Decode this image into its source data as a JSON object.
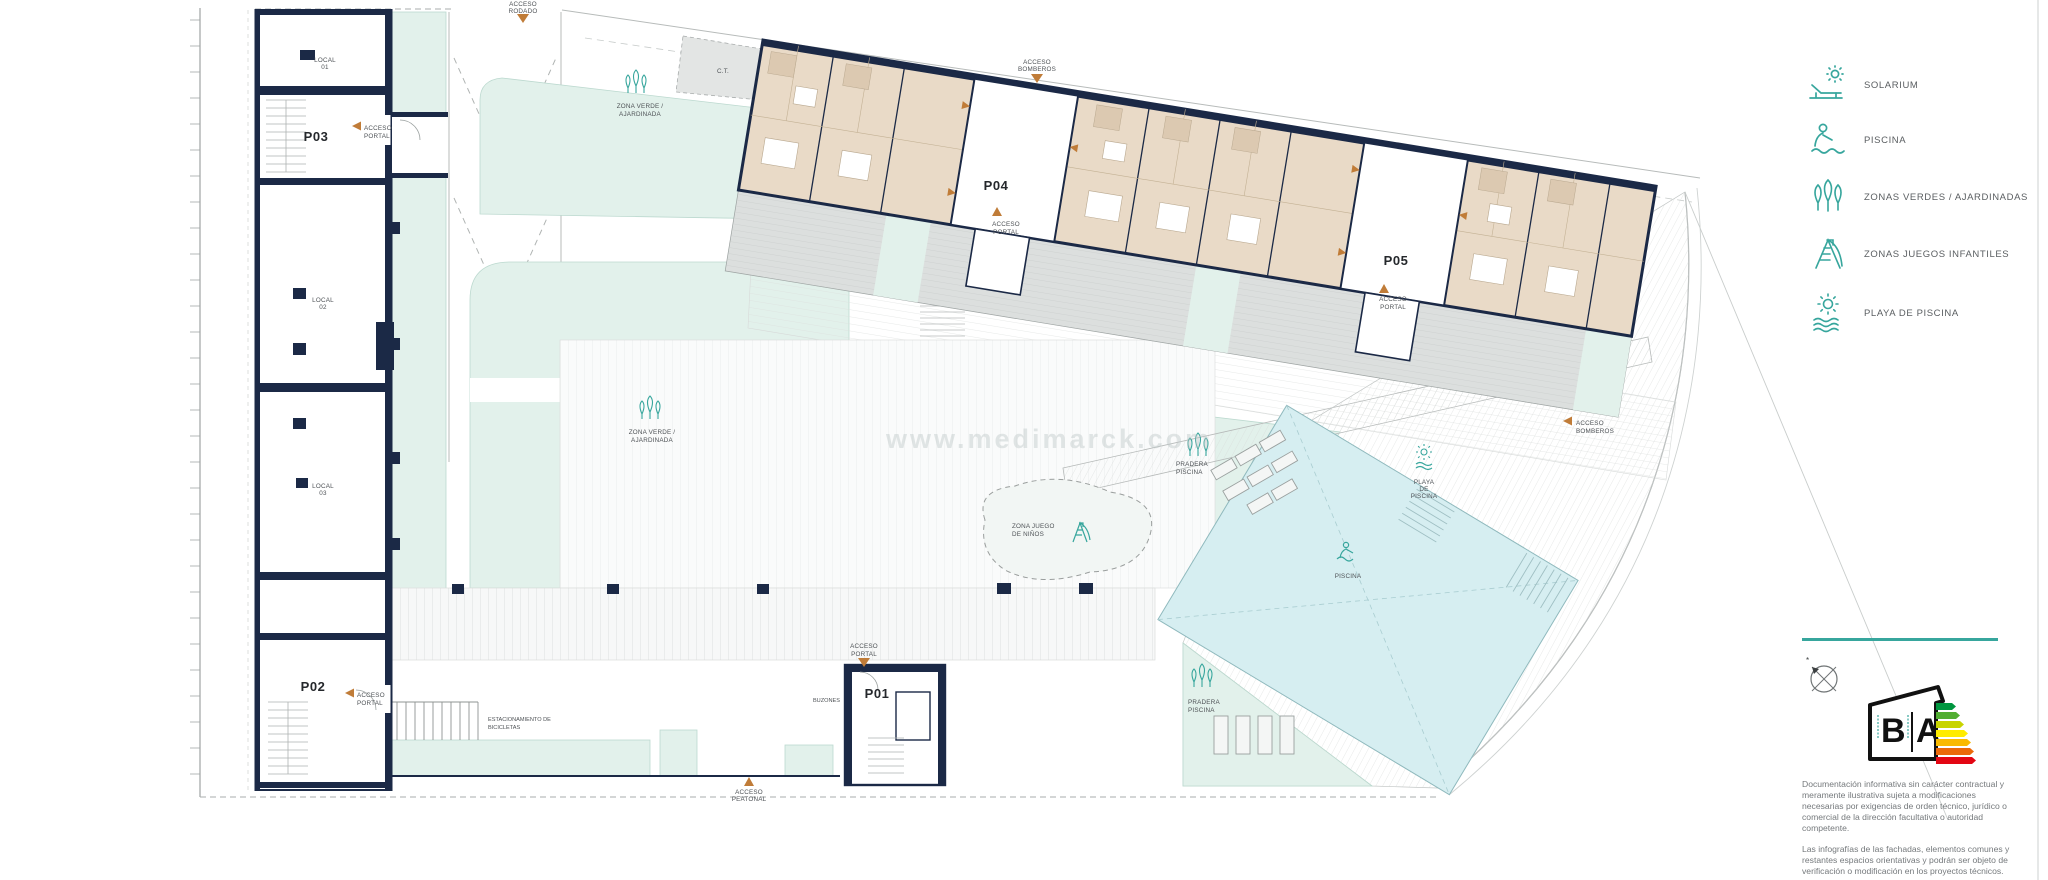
{
  "watermark": "www.medimarck.com",
  "legend": {
    "items": [
      {
        "icon": "solarium-icon",
        "label": "SOLARIUM"
      },
      {
        "icon": "pool-icon",
        "label": "PISCINA"
      },
      {
        "icon": "green-zones-icon",
        "label": "ZONAS VERDES / AJARDINADAS"
      },
      {
        "icon": "playground-icon",
        "label": "ZONAS JUEGOS INFANTILES"
      },
      {
        "icon": "pool-beach-icon",
        "label": "PLAYA DE PISCINA"
      }
    ]
  },
  "plan": {
    "portals": {
      "p01": "P01",
      "p02": "P02",
      "p03": "P03",
      "p04": "P04",
      "p05": "P05"
    },
    "locals": {
      "l1a": "LOCAL",
      "l1b": "01",
      "l2a": "LOCAL",
      "l2b": "02",
      "l3a": "LOCAL",
      "l3b": "03"
    },
    "labels": {
      "acceso": "ACCESO",
      "portal": "PORTAL",
      "rodado": "RODADO",
      "bomberos": "BOMBEROS",
      "peatonal": "PEATONAL",
      "zona_verde_1": "ZONA VERDE /",
      "zona_verde_2": "AJARDINADA",
      "pradera_1": "PRADERA",
      "pradera_2": "PISCINA",
      "playa_1": "PLAYA",
      "playa_2": "DE",
      "playa_3": "PISCINA",
      "piscina": "PISCINA",
      "zona_juego_1": "ZONA JUEGO",
      "zona_juego_2": "DE NIÑOS",
      "estacionamiento_1": "ESTACIONAMIENTO DE",
      "estacionamiento_2": "BICICLETAS",
      "buzones": "BUZONES",
      "ct": "C.T."
    }
  },
  "energy_badge": {
    "letter_left": "B",
    "letter_right": "A"
  },
  "disclaimer": {
    "p1": "Documentación informativa sin carácter contractual y meramente ilustrativa sujeta a modificaciones necesarias por exigencias de orden técnico, jurídico o comercial de la dirección facultativa o autoridad competente.",
    "p2": "Las infografías de las fachadas, elementos comunes y restantes espacios orientativas y podrán ser objeto de verificación o modificación en los proyectos técnicos.",
    "p3": "El mobiliario de las infografías no está incluido. Los acabados, calidades, colores."
  },
  "colors": {
    "accent_teal": "#37a69d",
    "navy": "#1b2946",
    "mint": "#e2f1eb",
    "pool_blue": "#d6eef1",
    "beige": "#e9dac7",
    "orange": "#c07c38",
    "energy_scale": [
      "#00963f",
      "#52ae32",
      "#c8d400",
      "#ffec00",
      "#faba00",
      "#eb6909",
      "#e30613"
    ]
  }
}
